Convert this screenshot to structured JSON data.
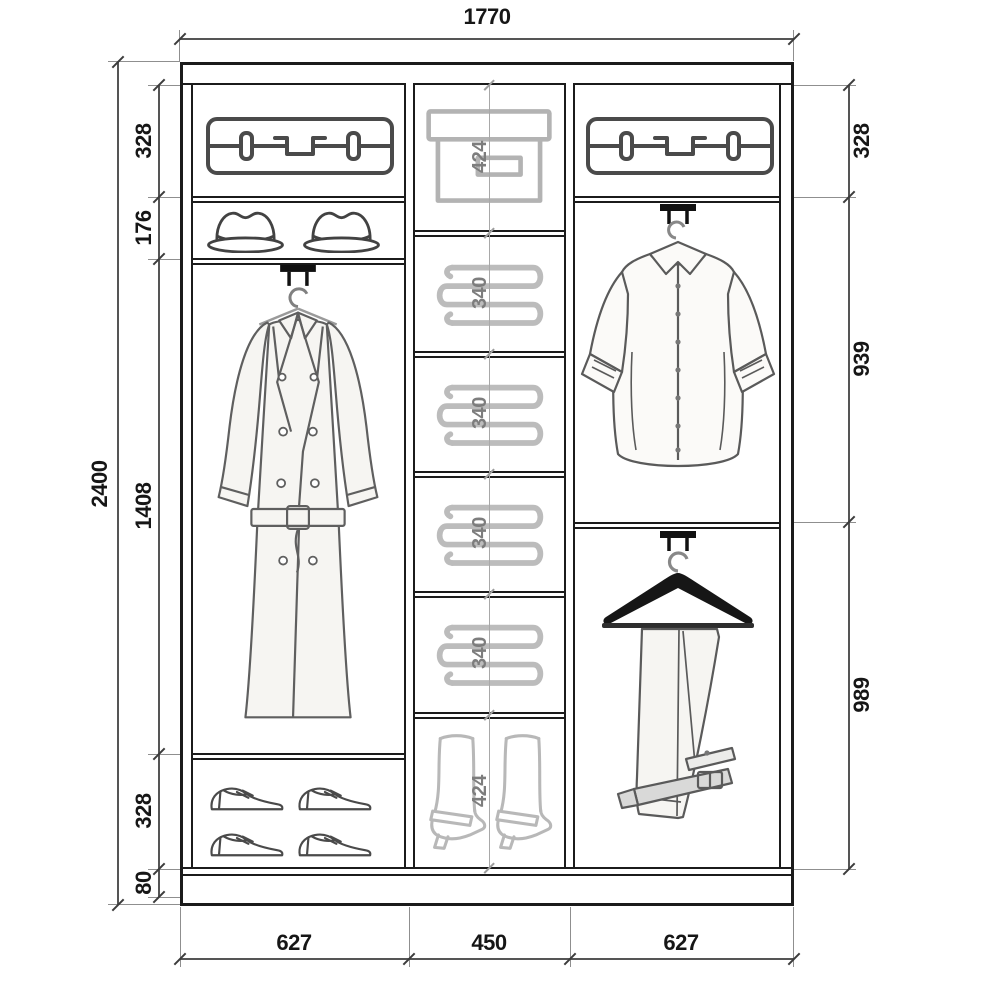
{
  "diagram": {
    "type": "wardrobe-interior-dimension-drawing",
    "units": "mm"
  },
  "dims": {
    "width_total": "1770",
    "height_total": "2400",
    "left": {
      "s1": "328",
      "s2": "176",
      "s3": "1408",
      "s4": "328",
      "s5": "80"
    },
    "middle": {
      "s1": "424",
      "s2": "340",
      "s3": "340",
      "s4": "340",
      "s5": "340",
      "s6": "424"
    },
    "right": {
      "s1": "328",
      "s2": "939",
      "s3": "989"
    },
    "bottom": {
      "w1": "627",
      "w2": "450",
      "w3": "627"
    }
  },
  "icons": {
    "left_top_shelf": "suitcase-icon",
    "left_hat_shelf": "fedora-hat-icon",
    "left_hanging_section": "trench-coat-on-hanger-icon",
    "left_shoe_shelf": "dress-shoe-icon",
    "middle_top_shelf": "storage-box-icon",
    "middle_linen_shelves": "folded-linen-icon",
    "middle_boot_shelf": "high-boot-icon",
    "right_top_shelf": "suitcase-icon",
    "right_upper_section": "shirt-on-hanger-icon",
    "right_lower_section": "trousers-on-hanger-icon"
  },
  "colors": {
    "background": "#ffffff",
    "frame_line": "#1b1b1b",
    "dimension_line": "#555555",
    "dimension_text": "#161616",
    "middle_dimension_text": "#7d7d7d",
    "light_icon": "#b8b8b8",
    "dark_icon": "#4a4a4a"
  }
}
